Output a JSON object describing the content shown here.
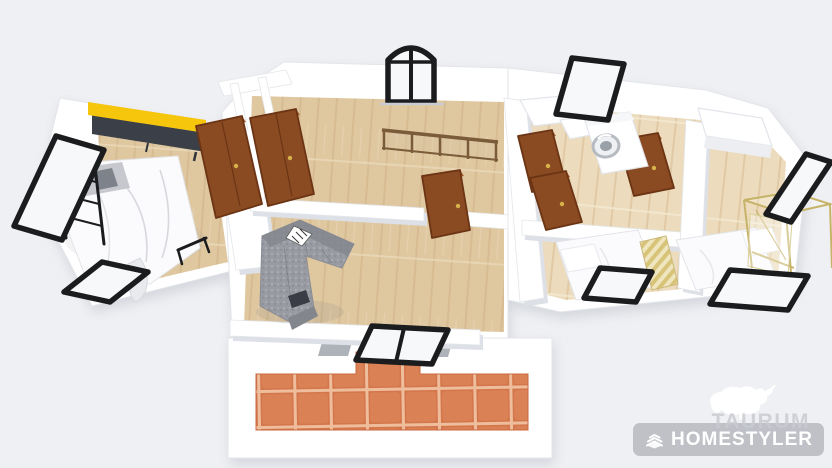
{
  "watermark": {
    "brand_top": "TAURUM",
    "brand_bottom": "HOMESTYLER",
    "logo_icon": "bull-icon",
    "badge_icon": "layers-icon"
  },
  "colors": {
    "bg": "#eff0f3",
    "wall": "#ffffff",
    "wall-shadow": "#dde0e6",
    "wood": "#dfc7a0",
    "wood-light": "#ecdcbd",
    "wood-plank": "#d0b286",
    "tile": "#d4764c",
    "tile-grout": "#eebe9c",
    "accent-yellow": "#f6c60d",
    "cabinet-dark": "#3a3f48",
    "door-brown": "#8a4a22",
    "frame-black": "#1b1c1e",
    "sofa-gray": "#989ba2",
    "railing-brown": "#7a5b3a",
    "brass-gold": "#c7b368",
    "watermark-gray": "#9b9da4",
    "watermark-taurum": "#c9cbd2"
  },
  "scene": {
    "type": "3d-floorplan-render",
    "rooms": [
      "bedroom-left",
      "hallway",
      "living-room",
      "balcony-terrace",
      "bathroom",
      "bedroom-middle-right",
      "bedroom-far-right"
    ],
    "furniture": [
      "yellow-sideboard",
      "double-bed-metal-frame",
      "wardrobe-doors",
      "stair-railing",
      "corner-sofa",
      "washing-machine",
      "single-bed-a",
      "single-bed-b",
      "brass-clothes-rack",
      "bathroom-counter",
      "white-cabinet"
    ],
    "openings": [
      "window-left",
      "window-bottom-left",
      "arched-window-top",
      "window-top-right",
      "window-far-right",
      "window-bottom-right-1",
      "window-bottom-right-2",
      "balcony-glass-door",
      "interior-doors-brown"
    ]
  }
}
